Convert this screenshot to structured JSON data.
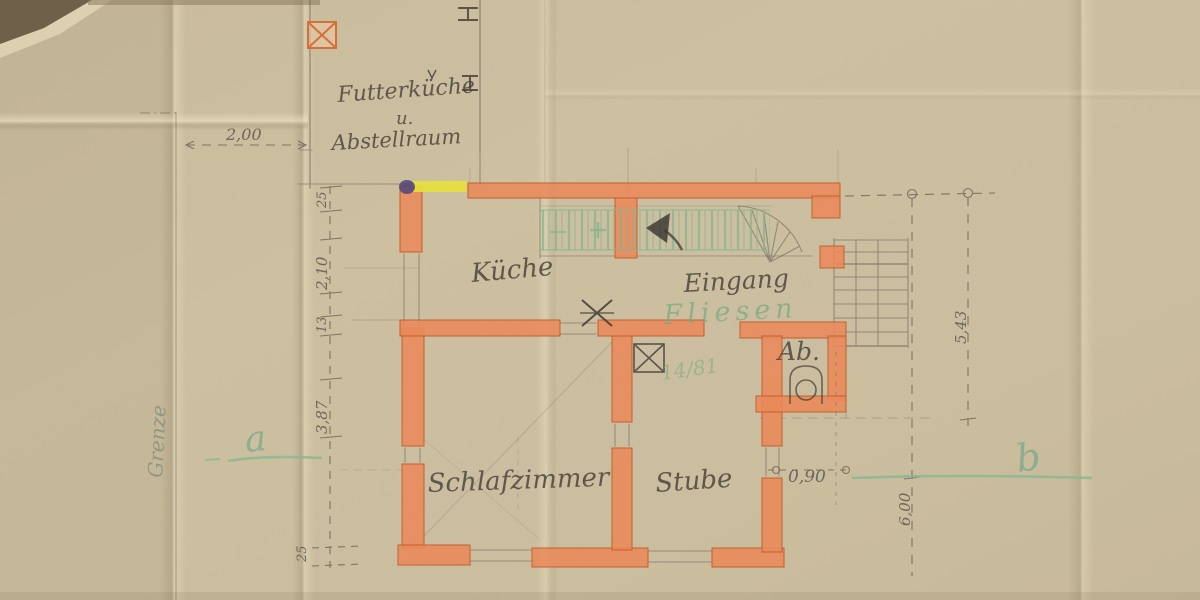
{
  "document": {
    "type": "hand-drawn floor plan (scan)",
    "language": "German"
  },
  "rooms": {
    "annex_line1": "Futterküche",
    "annex_line2": "u.",
    "annex_line3": "Abstellraum",
    "kueche": "Küche",
    "eingang": "Eingang",
    "fliesen_note": "Fliesen",
    "ab": "Ab.",
    "ref_number": "14/81",
    "schlafzimmer": "Schlafzimmer",
    "stube": "Stube"
  },
  "annotations": {
    "boundary": "Grenze",
    "marker_a": "a",
    "marker_b": "b"
  },
  "dimensions": {
    "annex_width": "2,00",
    "wall_top": "25",
    "kueche_depth": "2,10",
    "mid_wall": "13",
    "schlafzimmer_depth": "3,87",
    "wall_bottom": "25",
    "door_width": "0,90",
    "right_upper": "5,43",
    "right_lower": "6,00"
  },
  "colors": {
    "paper": "#cdc0a1",
    "wall_fill": "#e98a5a",
    "wall_edge": "#c4602f",
    "pencil": "#57514a",
    "green_ink": "#7fb08a",
    "door_highlight": "#e6df3e",
    "ink_blot": "#4d4479"
  }
}
